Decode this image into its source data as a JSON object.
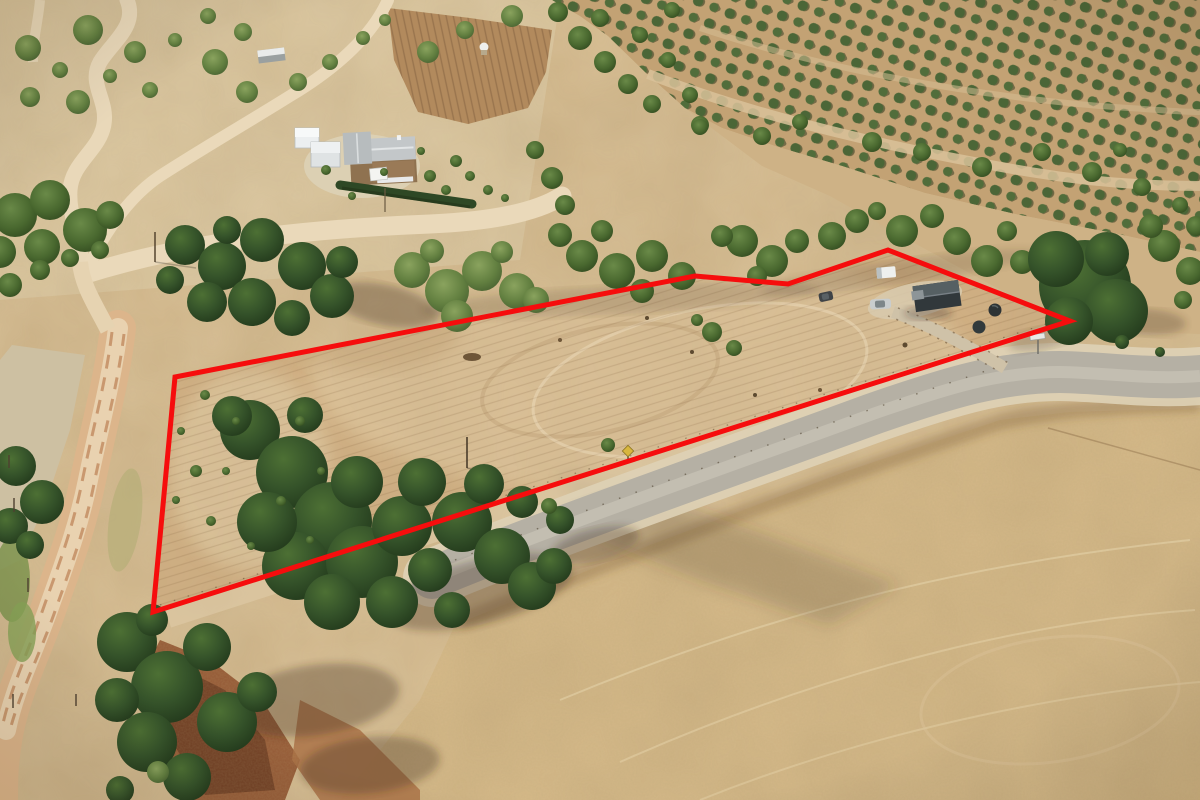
{
  "page": {
    "type": "aerial-drone-photograph",
    "description": "Aerial photo of a dry rural acreage for sale, outlined with a red boundary overlay. Golden summer paddocks, dark pine clusters, olive grove rows top-right, winding dirt roads left, a grey rural road crossing lower right, stone homestead with white sheds upper left, and a dark grey shed with vehicles inside the parcel.",
    "width_px": 1200,
    "height_px": 800
  },
  "boundary": {
    "label": "red property boundary outline",
    "color": "#f60d0d",
    "stroke_width": 5,
    "points": "153,612 175,377 695,276 788,284 888,250 1070,321",
    "vertex_count": 6
  },
  "palette": {
    "base_ground": "#d3b98d",
    "top_wash": "#d9c49c",
    "parcel_paddock": "#d1b185",
    "parcel_light": "#e4d0a9",
    "golden_field": "#d7bb8a",
    "grove_base": "#c3a274",
    "dry_slope": "#ceb286",
    "grey_road": "#b5b0a4",
    "road_casing": "#ded2b6",
    "dirt_road": "#e9d8b9",
    "red_dirt_track": "#d9ad82",
    "gully": "#955a36",
    "pine_dark": "#2c4423",
    "shadow": "#4a3f22"
  },
  "scene_objects": {
    "homestead": "stone house with grey iron roof",
    "homestead_sheds": "two white farm sheds",
    "hedge": "clipped dark hedge row",
    "parcel_shed": "dark grey gable shed",
    "truck": "white box truck",
    "silver_car": "silver sedan",
    "dark_car": "dark hatchback",
    "tanks": "two round rainwater tanks",
    "grove": "olive grove planted in diagonal rows",
    "grey_road": "sealed grey rural road",
    "dirt_roads": "winding unsealed tracks",
    "gully": "eroded red-soil gully",
    "sign_yellow": "small yellow roadside sign",
    "sign_white": "white street sign at junction"
  }
}
